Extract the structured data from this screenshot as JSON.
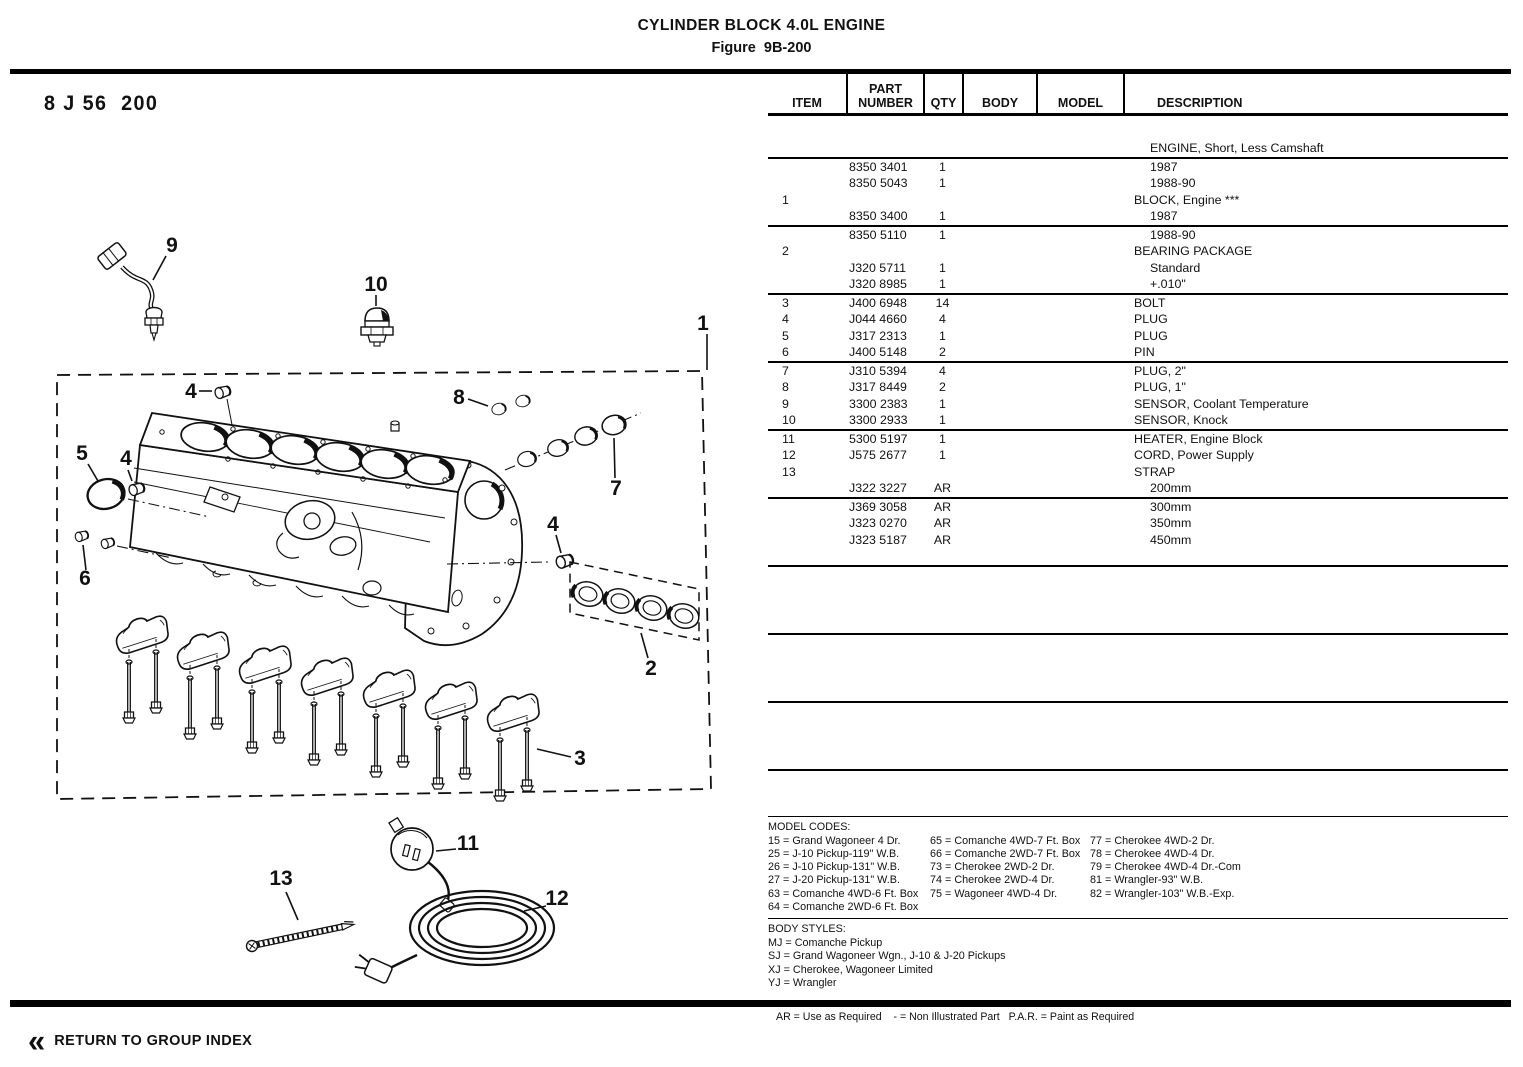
{
  "page": {
    "title": "CYLINDER BLOCK 4.0L ENGINE",
    "figure": "Figure  9B-200",
    "stamp": "8 J 56  200",
    "legend_note": "AR = Use as Required    - = Non Illustrated Part   P.A.R. = Paint as Required",
    "return_icon": "«",
    "return_label": "RETURN TO GROUP INDEX",
    "colors": {
      "ink": "#111111",
      "paper": "#ffffff"
    }
  },
  "table": {
    "headers": {
      "item": "ITEM",
      "part_line1": "PART",
      "part_line2": "NUMBER",
      "qty": "QTY",
      "body": "BODY",
      "model": "MODEL",
      "description": "DESCRIPTION"
    },
    "groups": [
      [
        {
          "d": "ENGINE, Short, Less Camshaft",
          "ind": "ind"
        }
      ],
      [
        {
          "p": "8350 3401",
          "q": "1",
          "d": "1987",
          "ind": "ind"
        },
        {
          "p": "8350 5043",
          "q": "1",
          "d": "1988-90",
          "ind": "ind"
        },
        {
          "i": "1",
          "d": "BLOCK, Engine ***"
        },
        {
          "p": "8350 3400",
          "q": "1",
          "d": "1987",
          "ind": "ind"
        }
      ],
      [
        {
          "p": "8350 5110",
          "q": "1",
          "d": "1988-90",
          "ind": "ind"
        },
        {
          "i": "2",
          "d": "BEARING PACKAGE"
        },
        {
          "p": "J320 5711",
          "q": "1",
          "d": "Standard",
          "ind": "ind"
        },
        {
          "p": "J320 8985",
          "q": "1",
          "d": "+.010\"",
          "ind": "ind"
        }
      ],
      [
        {
          "i": "3",
          "p": "J400 6948",
          "q": "14",
          "d": "BOLT"
        },
        {
          "i": "4",
          "p": "J044 4660",
          "q": "4",
          "d": "PLUG"
        },
        {
          "i": "5",
          "p": "J317 2313",
          "q": "1",
          "d": "PLUG"
        },
        {
          "i": "6",
          "p": "J400 5148",
          "q": "2",
          "d": "PIN"
        }
      ],
      [
        {
          "i": "7",
          "p": "J310 5394",
          "q": "4",
          "d": "PLUG, 2\""
        },
        {
          "i": "8",
          "p": "J317 8449",
          "q": "2",
          "d": "PLUG, 1\""
        },
        {
          "i": "9",
          "p": "3300 2383",
          "q": "1",
          "d": "SENSOR, Coolant Temperature"
        },
        {
          "i": "10",
          "p": "3300 2933",
          "q": "1",
          "d": "SENSOR, Knock"
        }
      ],
      [
        {
          "i": "11",
          "p": "5300 5197",
          "q": "1",
          "d": "HEATER, Engine Block"
        },
        {
          "i": "12",
          "p": "J575 2677",
          "q": "1",
          "d": "CORD, Power Supply"
        },
        {
          "i": "13",
          "d": "STRAP"
        },
        {
          "p": "J322 3227",
          "q": "AR",
          "d": "200mm",
          "ind": "ind"
        }
      ],
      [
        {
          "p": "J369 3058",
          "q": "AR",
          "d": "300mm",
          "ind": "ind"
        },
        {
          "p": "J323 0270",
          "q": "AR",
          "d": "350mm",
          "ind": "ind"
        },
        {
          "p": "J323 5187",
          "q": "AR",
          "d": "450mm",
          "ind": "ind"
        }
      ],
      [],
      [],
      []
    ]
  },
  "model_codes": {
    "title": "MODEL CODES:",
    "col1": [
      "15 = Grand Wagoneer 4 Dr.",
      "25 = J-10 Pickup-119\" W.B.",
      "26 = J-10 Pickup-131\" W.B.",
      "27 = J-20 Pickup-131\" W.B.",
      "63 = Comanche 4WD-6 Ft. Box",
      "64 = Comanche 2WD-6 Ft. Box"
    ],
    "col2": [
      "65 = Comanche 4WD-7 Ft. Box",
      "66 = Comanche 2WD-7 Ft. Box",
      "73 = Cherokee 2WD-2 Dr.",
      "74 = Cherokee 2WD-4 Dr.",
      "75 = Wagoneer 4WD-4 Dr."
    ],
    "col3": [
      "77 = Cherokee 4WD-2 Dr.",
      "78 = Cherokee 4WD-4 Dr.",
      "79 = Cherokee 4WD-4 Dr.-Com",
      "81 = Wrangler-93\" W.B.",
      "82 = Wrangler-103\" W.B.-Exp."
    ]
  },
  "body_styles": {
    "title": "BODY STYLES:",
    "items": [
      "MJ = Comanche Pickup",
      "SJ = Grand Wagoneer Wgn., J-10 & J-20 Pickups",
      "XJ = Cherokee, Wagoneer Limited",
      "YJ = Wrangler"
    ]
  },
  "diagram": {
    "callouts": {
      "c1": "1",
      "c2": "2",
      "c3": "3",
      "c4a": "4",
      "c4b": "4",
      "c4c": "4",
      "c5": "5",
      "c6": "6",
      "c7": "7",
      "c8": "8",
      "c9": "9",
      "c10": "10",
      "c11": "11",
      "c12": "12",
      "c13": "13"
    }
  }
}
